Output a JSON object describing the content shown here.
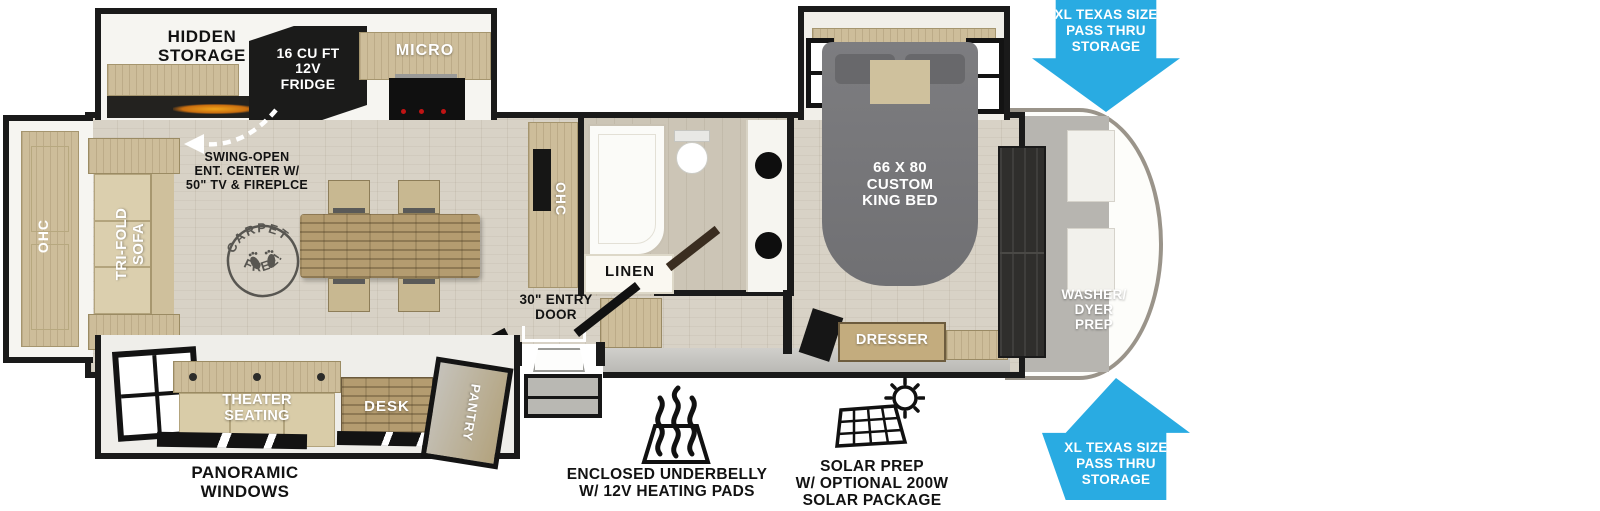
{
  "plan": {
    "hidden_storage": "HIDDEN\nSTORAGE",
    "fridge": "16 CU FT\n12V\nFRIDGE",
    "micro": "MICRO",
    "rear_ohc": "OHC",
    "sofa": "TRI-FOLD\nSOFA",
    "ent_center": "SWING-OPEN\nENT. CENTER W/\n50\" TV & FIREPLCE",
    "carpet_top": "CARPET",
    "carpet_bottom": "FREE!",
    "kitchen_ohc": "OHC",
    "linen": "LINEN",
    "entry_door": "30\" ENTRY\nDOOR",
    "king_bed": "66 X 80\nCUSTOM\nKING BED",
    "dresser": "DRESSER",
    "washer_prep": "WASHER/\nDYER\nPREP",
    "theater": "THEATER\nSEATING",
    "desk": "DESK",
    "pantry": "PANTRY",
    "pass_thru_top": "XL TEXAS SIZE\nPASS THRU\nSTORAGE",
    "pass_thru_bottom": "XL TEXAS SIZE\nPASS THRU\nSTORAGE"
  },
  "features": {
    "panoramic": "PANORAMIC\nWINDOWS",
    "underbelly": "ENCLOSED UNDERBELLY\nW/ 12V HEATING PADS",
    "solar": "SOLAR PREP\nW/ OPTIONAL 200W\nSOLAR PACKAGE"
  },
  "colors": {
    "arrow_blue": "#29ABE2",
    "wall_black": "#1A1A1A",
    "cabinet_tan": "#CDBD9A",
    "table_wood": "#B49C70",
    "bed_gray": "#77777A",
    "floor": "#D8D2C6",
    "fridge_black": "#1B1B1A"
  }
}
